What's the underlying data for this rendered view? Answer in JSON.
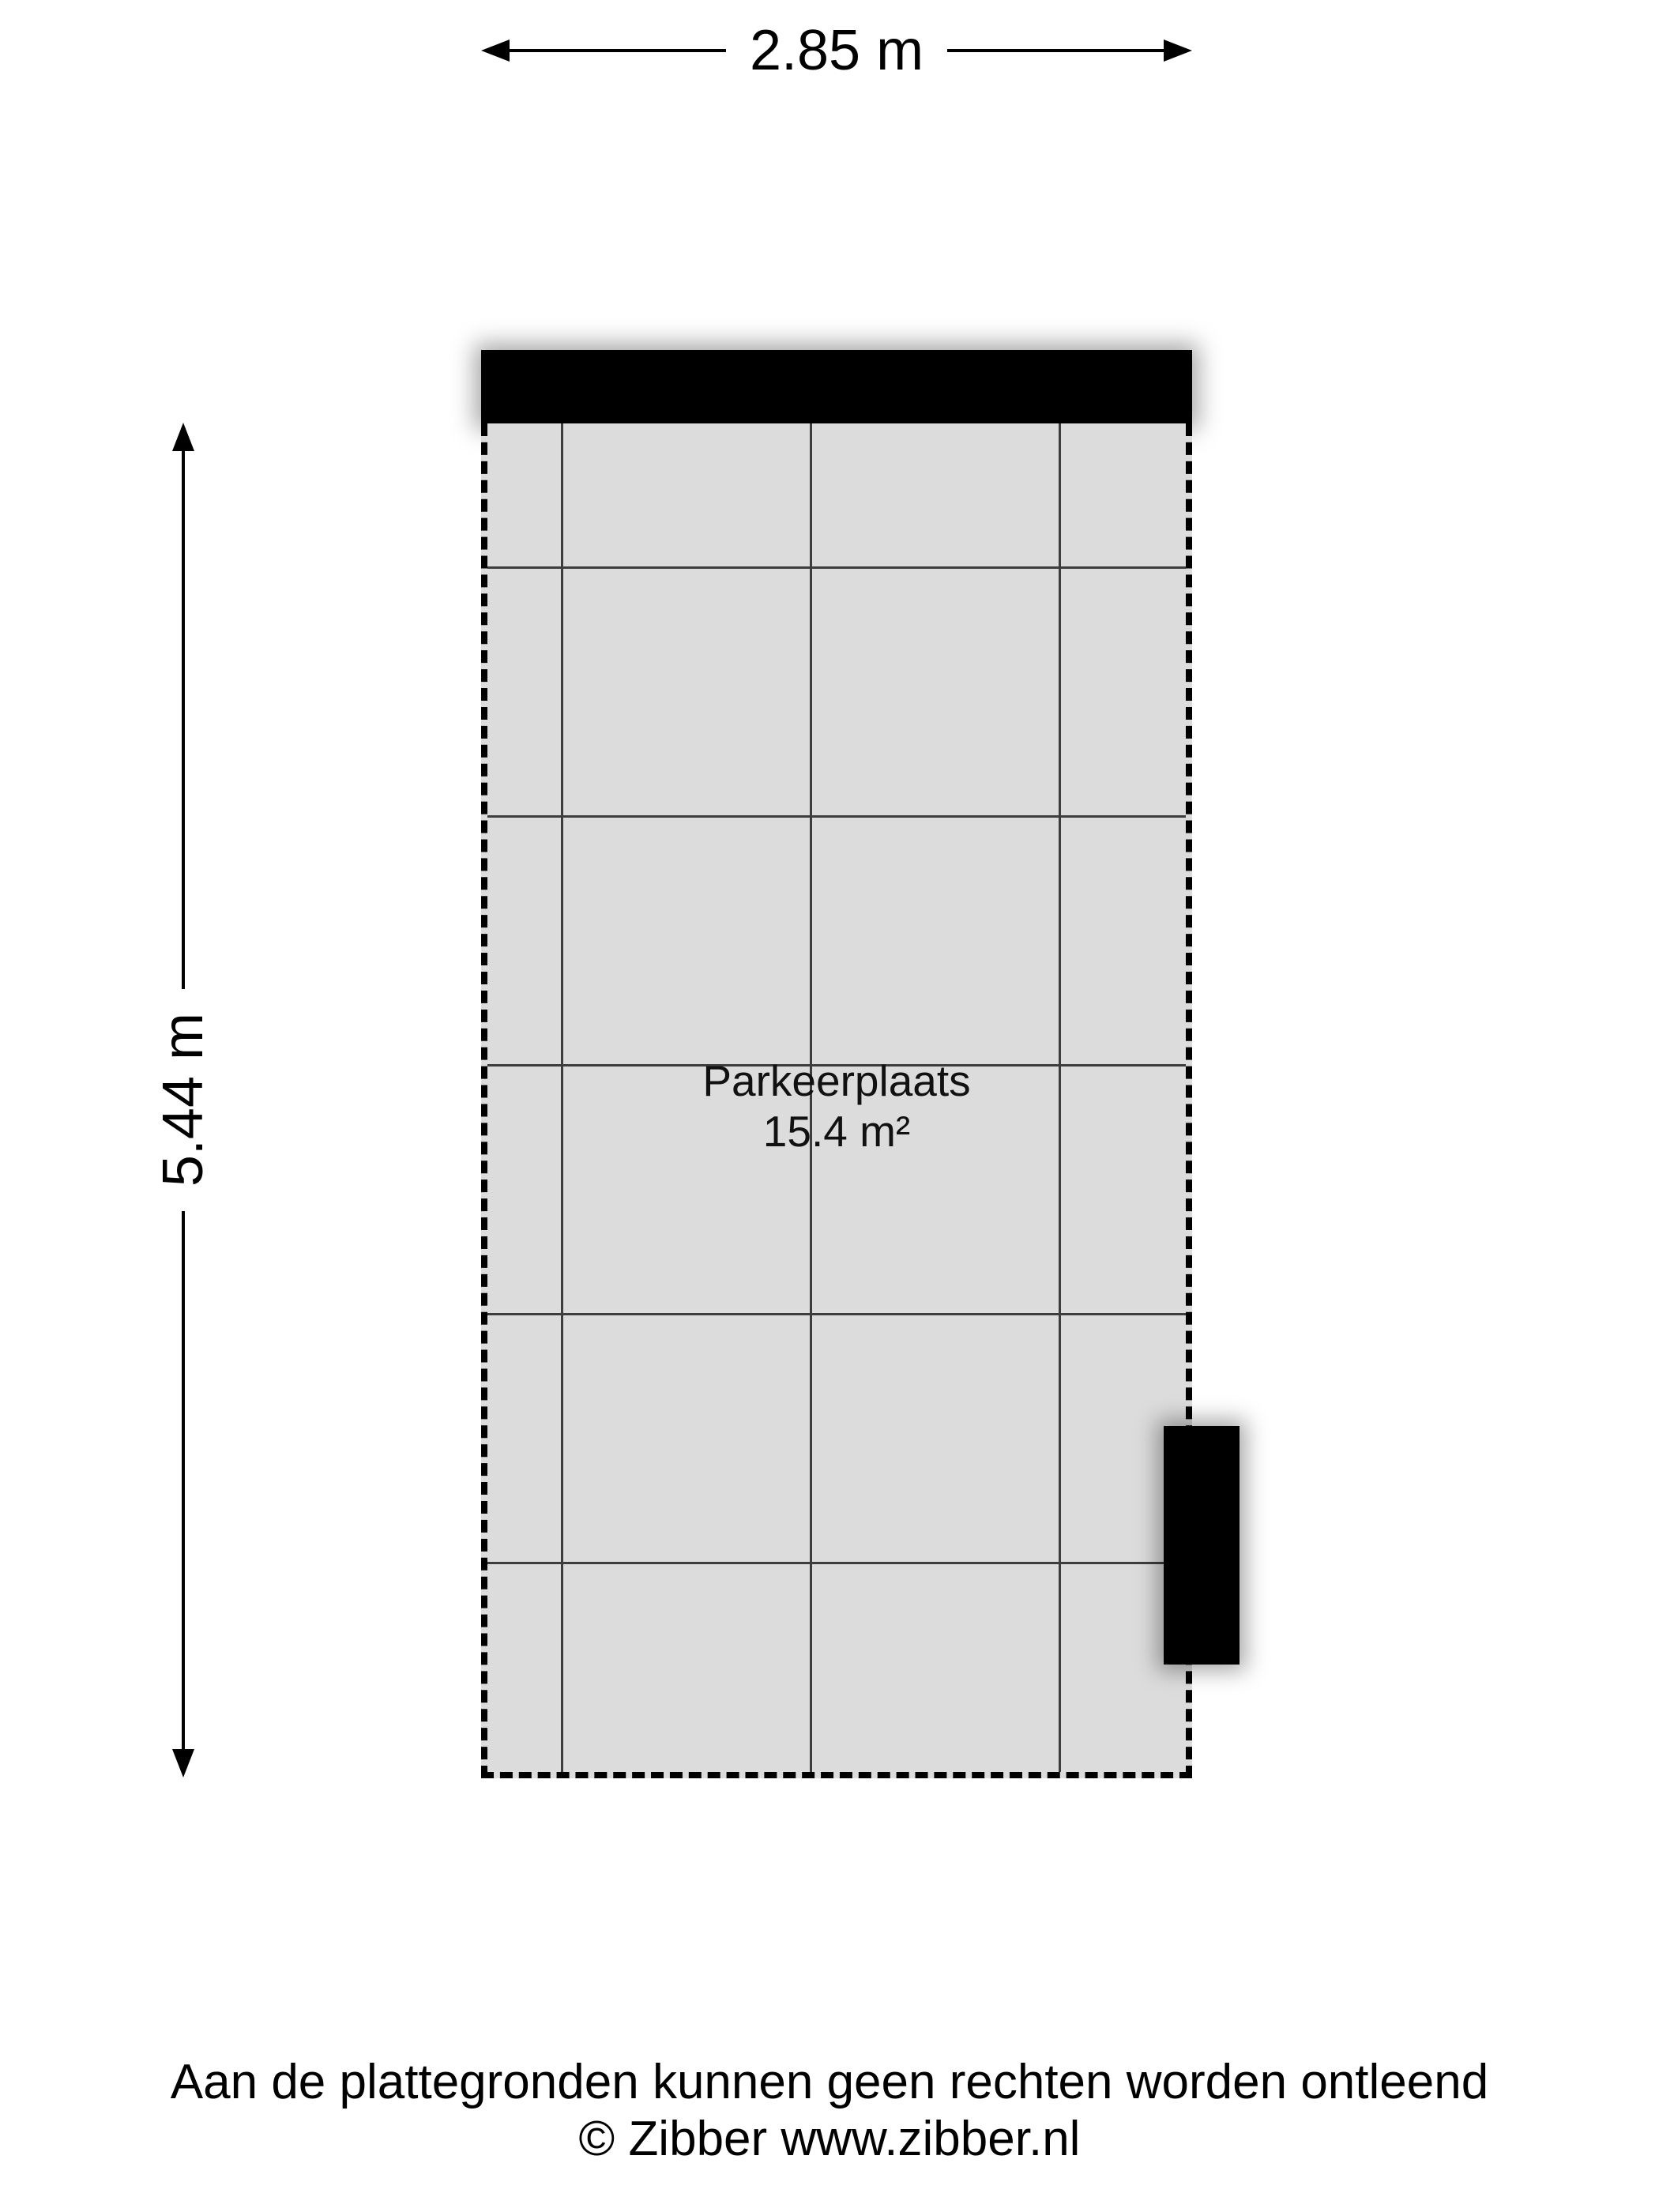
{
  "dimensions": {
    "width_label": "2.85 m",
    "height_label": "5.44 m"
  },
  "room": {
    "name": "Parkeerplaats",
    "area": "15.4 m²"
  },
  "footer": {
    "disclaimer": "Aan de plattegronden kunnen geen rechten worden ontleend",
    "copyright": "© Zibber www.zibber.nl"
  },
  "colors": {
    "background": "#ffffff",
    "floor_fill": "#dcdcdc",
    "grid_line": "#3d3d3d",
    "wall": "#000000",
    "text": "#000000"
  }
}
